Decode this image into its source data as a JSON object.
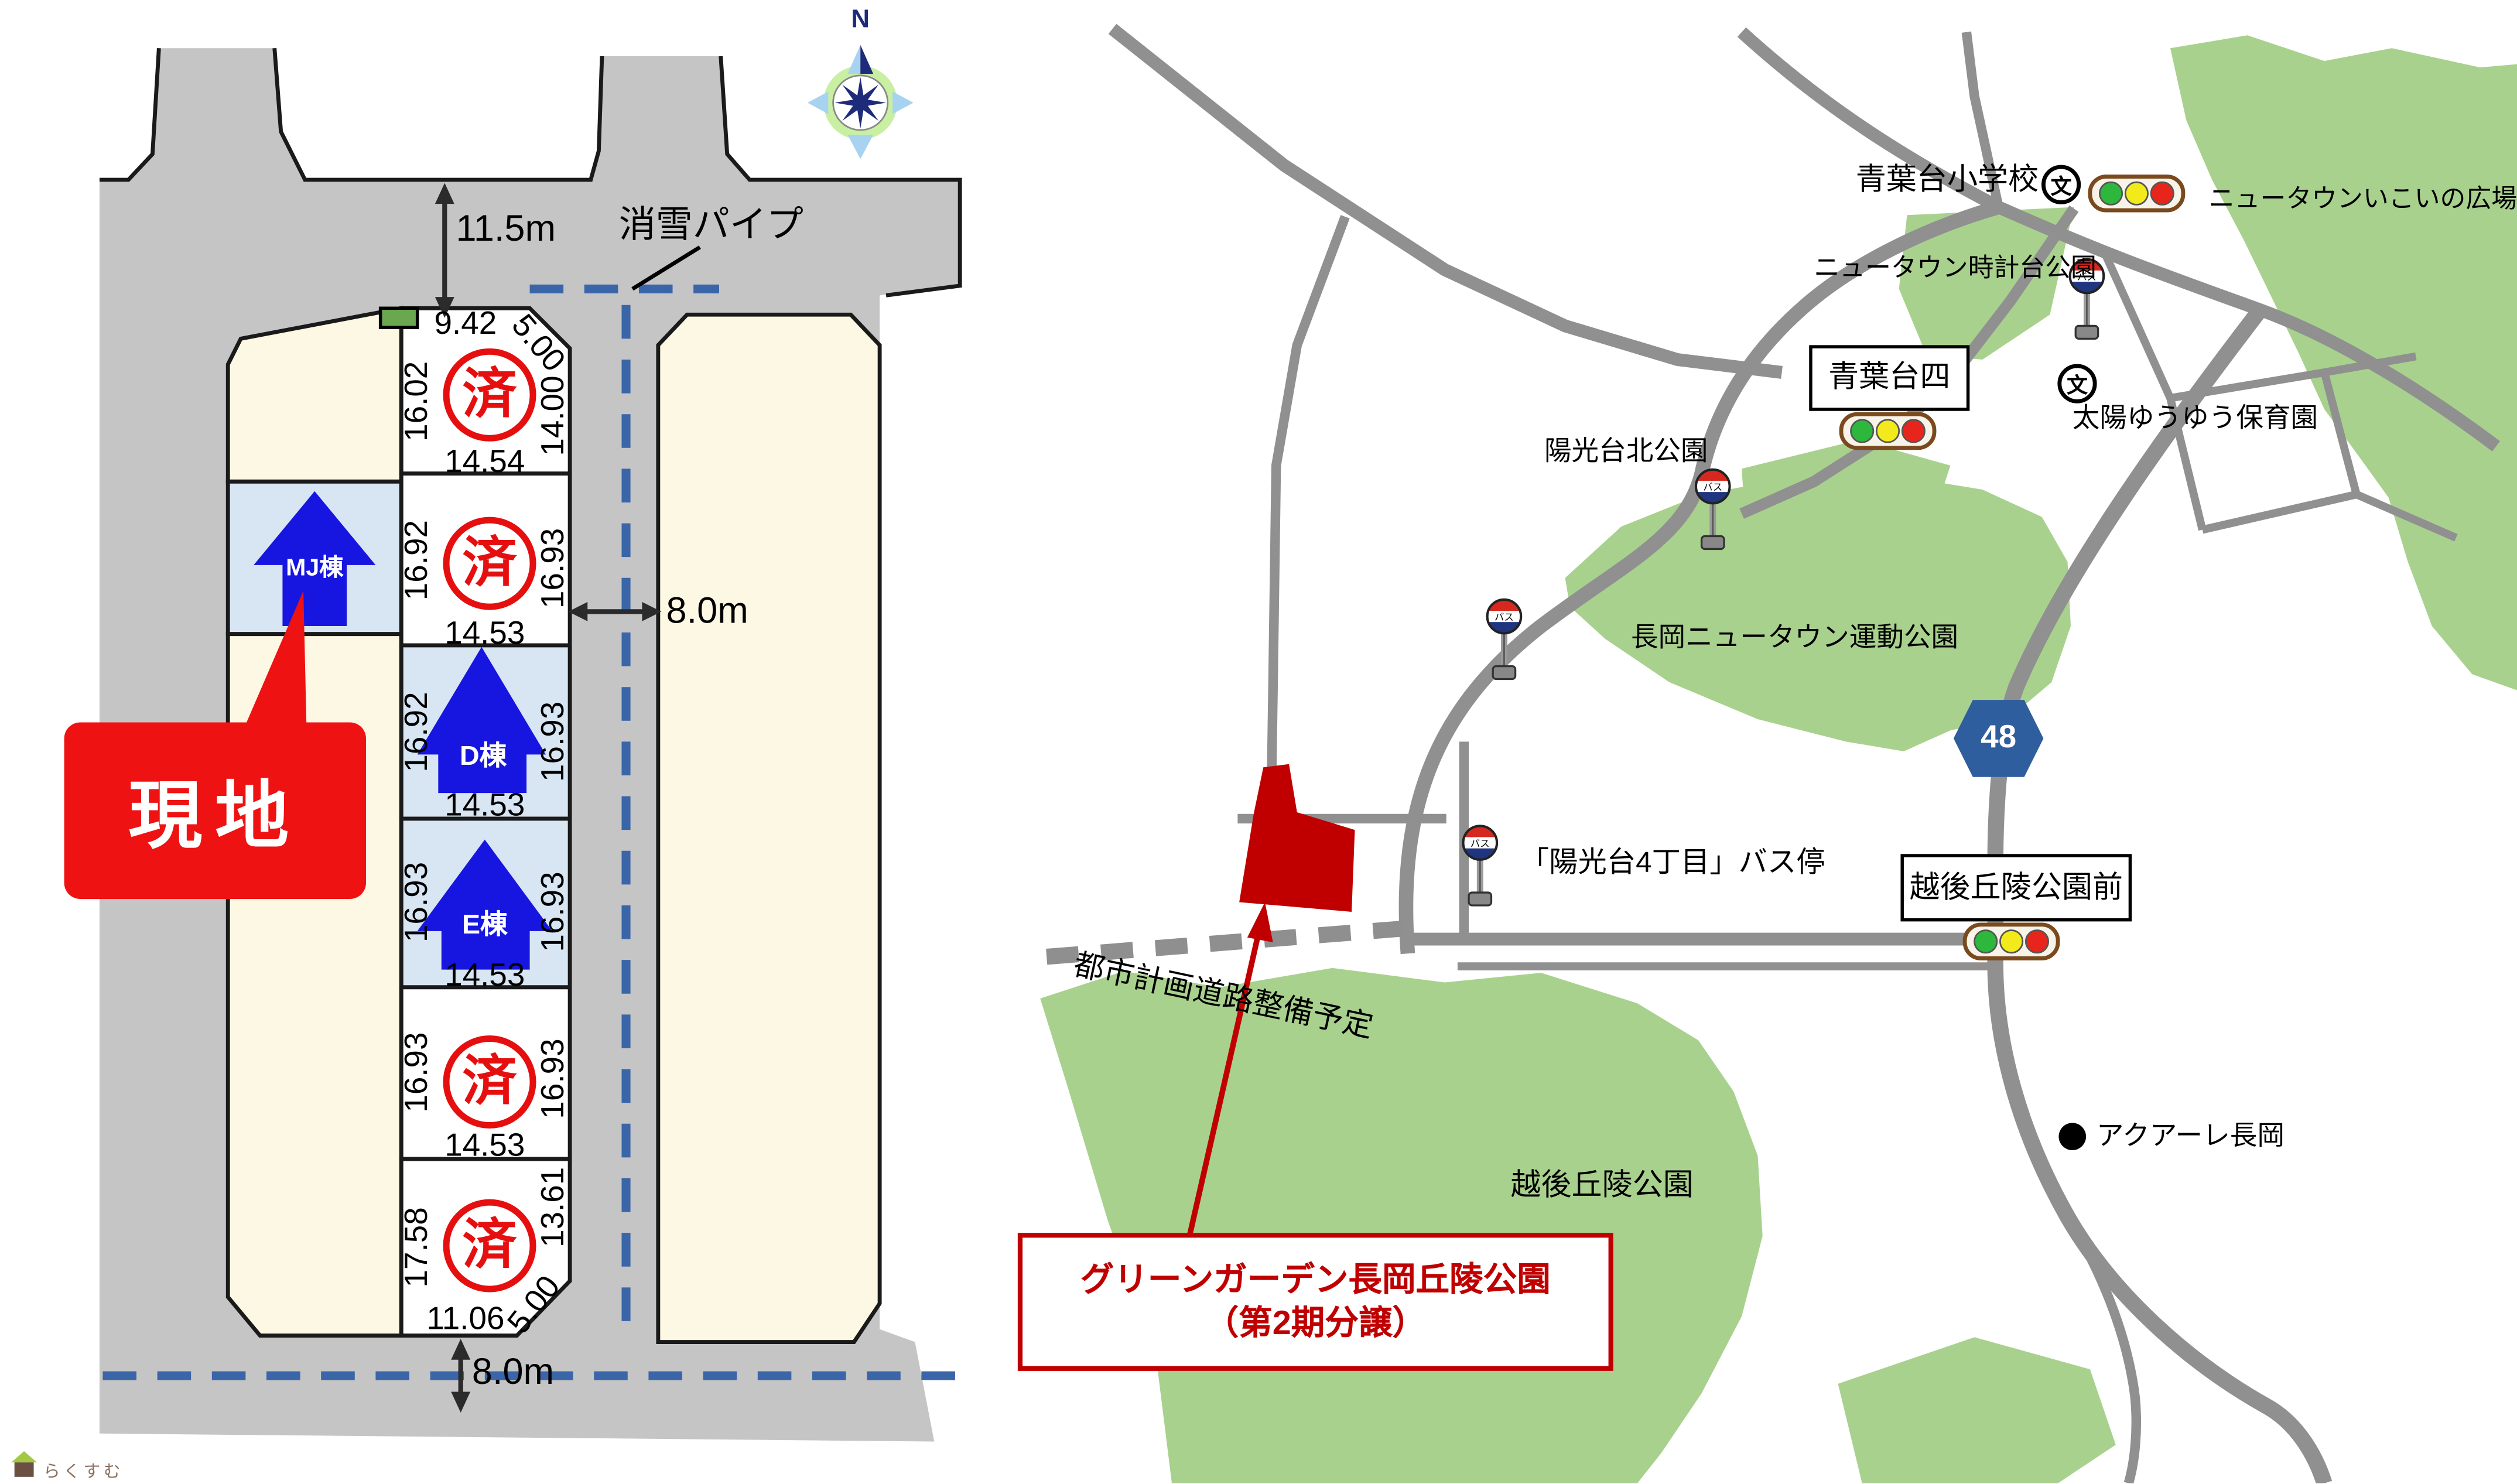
{
  "site_plan": {
    "compass": "N",
    "snow_pipe_label": "消雪パイプ",
    "road_widths": {
      "top": "11.5m",
      "side": "8.0m",
      "bottom": "8.0m"
    },
    "site_marker": "現地",
    "sold_stamp": "済",
    "buildings": {
      "mj": "MJ棟",
      "d": "D棟",
      "e": "E棟"
    },
    "lots": [
      {
        "id": "1",
        "status": "sold",
        "top": "9.42",
        "corner": "5.00",
        "left": "16.02",
        "right": "14.00",
        "bottom": "14.54"
      },
      {
        "id": "2",
        "status": "sold",
        "left": "16.92",
        "right": "16.93",
        "bottom": "14.53"
      },
      {
        "id": "D",
        "status": "for-sale",
        "building": "D棟",
        "left": "16.92",
        "right": "16.93",
        "bottom": "14.53"
      },
      {
        "id": "E",
        "status": "for-sale",
        "building": "E棟",
        "left": "16.93",
        "right": "16.93",
        "bottom": "14.53"
      },
      {
        "id": "5",
        "status": "sold",
        "left": "16.93",
        "right": "16.93",
        "bottom": "14.53"
      },
      {
        "id": "6",
        "status": "sold",
        "left": "17.58",
        "right": "13.61",
        "bottom": "11.06",
        "corner": "5.00"
      }
    ]
  },
  "map": {
    "places": {
      "aobadai_elementary_school": "青葉台小学校",
      "newtown_ikoi_plaza": "ニュータウンいこいの広場",
      "newtown_clock_tower_park": "ニュータウン時計台公園",
      "aobadai_4_sign": "青葉台四",
      "taiyo_yuyu_nursery": "太陽ゆうゆう保育園",
      "yokodai_north_park": "陽光台北公園",
      "nagaoka_newtown_sports_park": "長岡ニュータウン運動公園",
      "yokodai_4_bus_stop": "「陽光台4丁目」バス停",
      "echigo_kyuryo_park_front_sign": "越後丘陵公園前",
      "echigo_kyuryo_park": "越後丘陵公園",
      "aquare_nagaoka": "アクアーレ長岡",
      "planned_city_road": "都市計画道路整備予定"
    },
    "route_badge": "48",
    "school_icon_char": "文",
    "bus_icon_text": "バス",
    "callout": {
      "line1": "グリーンガーデン長岡丘陵公園",
      "line2": "（第2期分譲）"
    }
  },
  "watermark": "らくすむ",
  "colors": {
    "accent_red": "#c00000",
    "site_red": "#ee1212",
    "sold_red": "#e60f0f",
    "arrow_blue": "#1616e0",
    "pipe_blue": "#3a65a8",
    "map_green": "#a9d18e",
    "road_gray": "#909090",
    "plan_road_gray": "#c5c5c5",
    "badge_blue": "#2f5e9e",
    "lot_cream": "#fcf8e3",
    "lot_blue": "#d8e5f3"
  }
}
